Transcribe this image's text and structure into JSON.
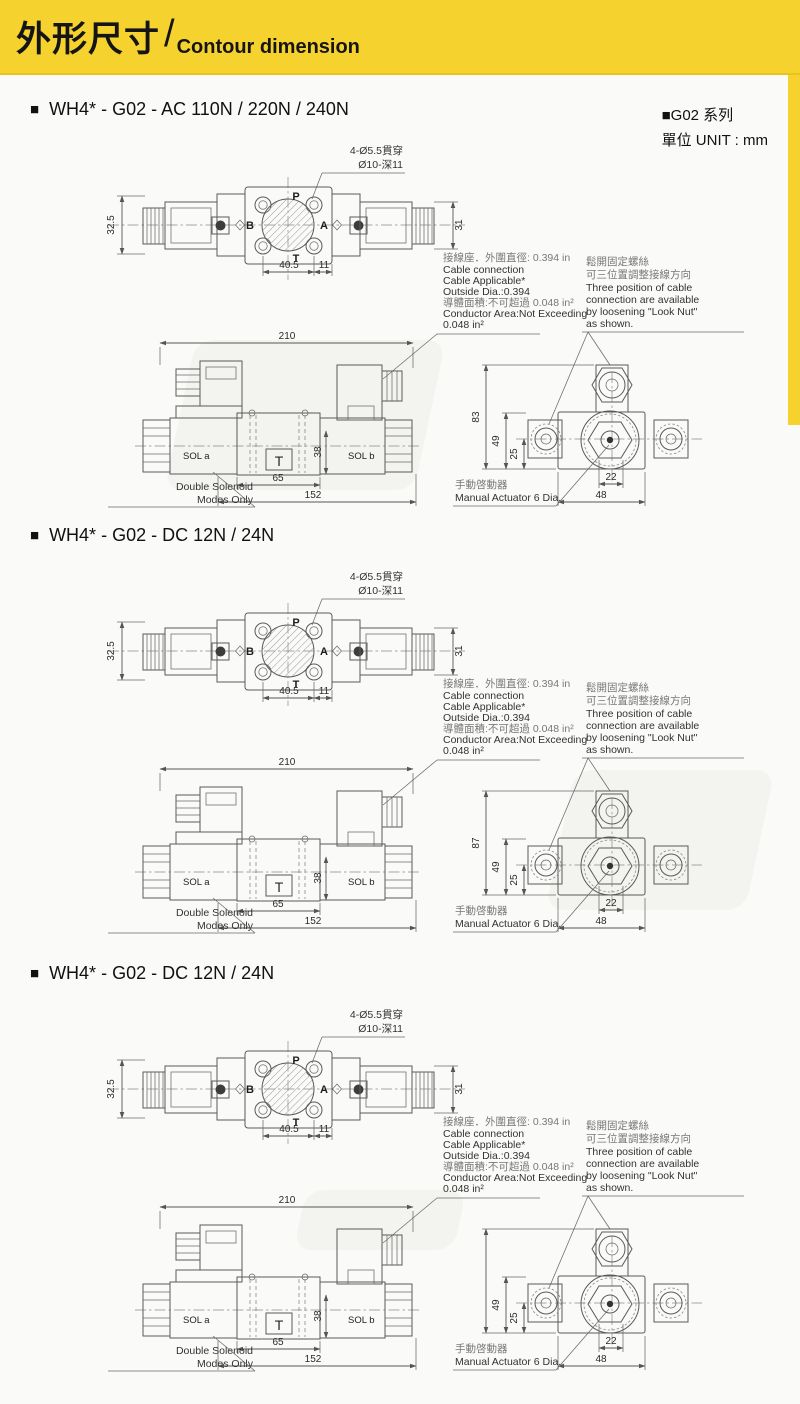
{
  "header": {
    "title_zh": "外形尺寸",
    "divider": "/",
    "title_en": "Contour dimension"
  },
  "unit_note": {
    "series": "■G02 系列",
    "unit_zh": "單位",
    "unit_en": "UNIT : mm"
  },
  "shared": {
    "bullet": "■",
    "hole_callout": {
      "line1": "4-Ø5.5貫穿",
      "line2": "Ø10-深11"
    },
    "ports": {
      "p": "P",
      "a": "A",
      "b": "B",
      "t": "T"
    },
    "top_dims": {
      "height_left": "32.5",
      "height_right": "31",
      "hole_span": "40.5",
      "hole_edge": "11"
    },
    "cable_note": {
      "l1": "接線座．外圍直徑: 0.394 in",
      "l2": "Cable connection",
      "l3": "Cable Applicable*",
      "l4": "Outside Dia.:0.394",
      "l5": "導體面積:不可超過 0.048 in²",
      "l6": "Conductor Area:Not Exceeding",
      "l7": "0.048 in²"
    },
    "position_note": {
      "l1": "鬆開固定螺絲",
      "l2": "可三位置調整接線方向",
      "l3": "Three position of cable",
      "l4": "connection are available",
      "l5": "by loosening \"Look Nut\"",
      "l6": "as shown."
    },
    "side": {
      "overall": "210",
      "block": "65",
      "body": "152",
      "height": "38",
      "sol_a": "SOL a",
      "sol_b": "SOL b",
      "tank": "T",
      "note1": "Double Solenoid",
      "note2": "Modes Only"
    },
    "end": {
      "d49": "49",
      "d25": "25",
      "d22": "22",
      "d48": "48",
      "note1": "手動啓動器",
      "note2": "Manual Actuator 6 Dia."
    }
  },
  "sections": [
    {
      "title": "WH4* - G02 - AC 110N / 220N / 240N",
      "end_height": "83"
    },
    {
      "title": "WH4* - G02 - DC 12N / 24N",
      "end_height": "87"
    },
    {
      "title": "WH4* - G02 - DC 12N / 24N",
      "end_height": ""
    }
  ]
}
